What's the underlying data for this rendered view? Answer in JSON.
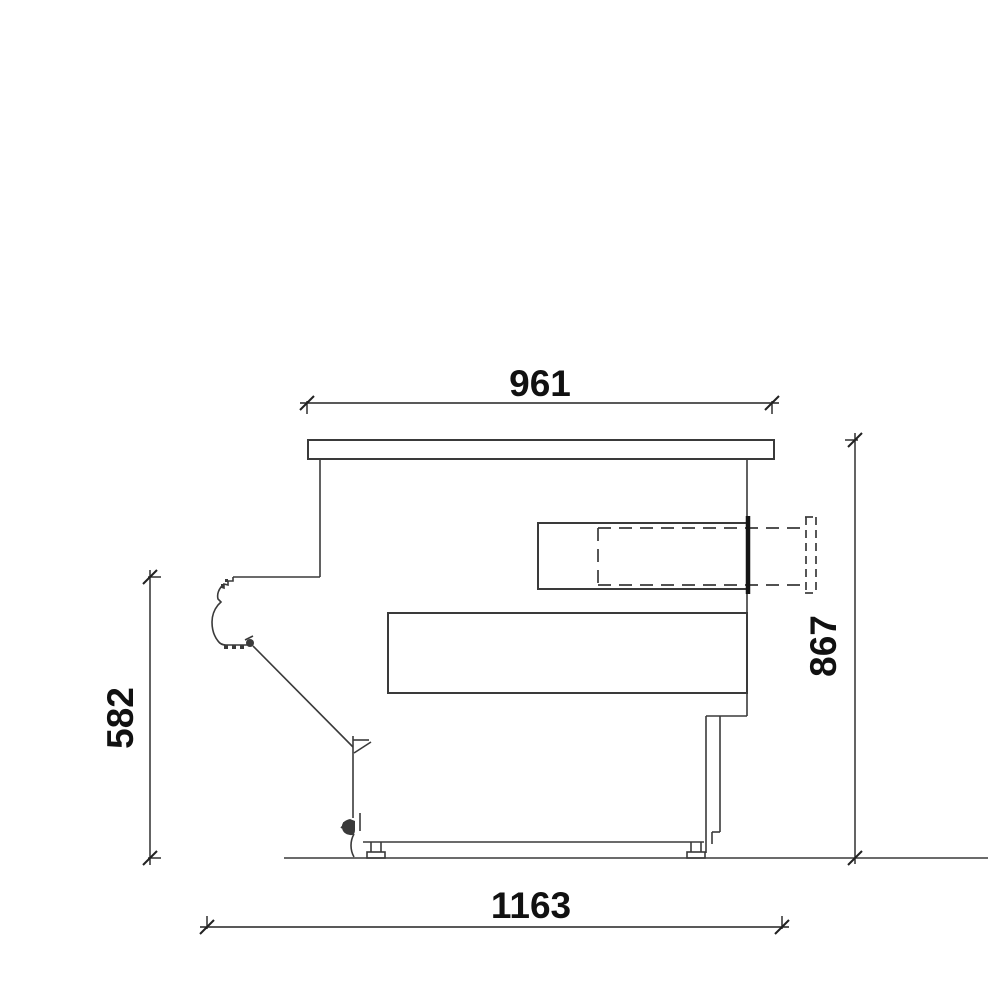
{
  "drawing": {
    "type": "technical-section-side-view",
    "background": "#ffffff",
    "line_color": "#3a3a3a",
    "text_color": "#111111",
    "dimensions": {
      "top_width": {
        "label": "961",
        "orientation": "horizontal",
        "position": "top"
      },
      "bottom_width": {
        "label": "1163",
        "orientation": "horizontal",
        "position": "bottom"
      },
      "left_height": {
        "label": "582",
        "orientation": "vertical",
        "position": "left"
      },
      "right_height": {
        "label": "867",
        "orientation": "vertical",
        "position": "right"
      }
    }
  }
}
